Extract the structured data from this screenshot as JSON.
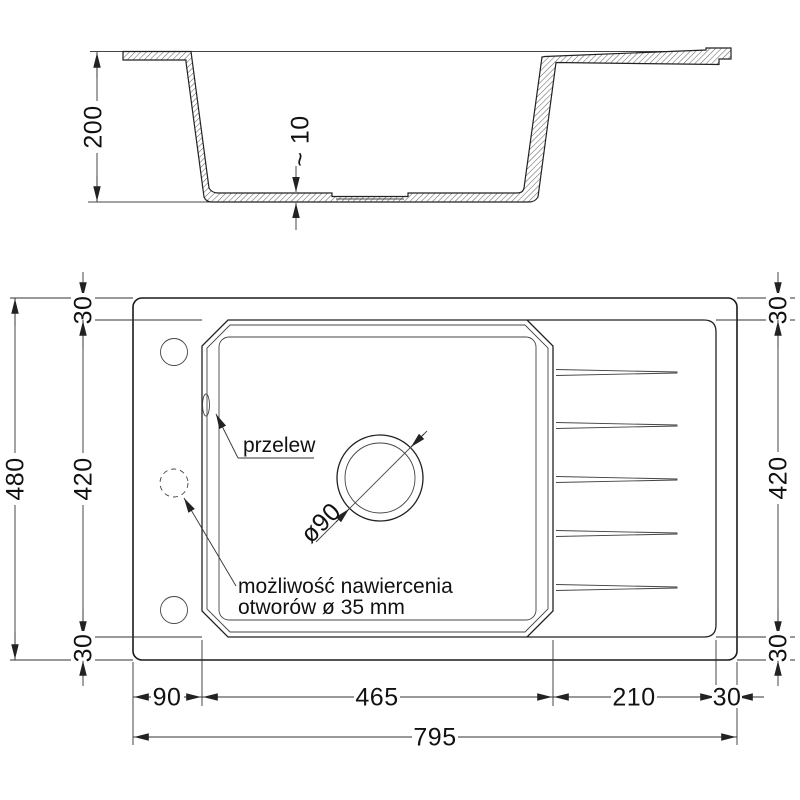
{
  "section_view": {
    "dim_height": "200",
    "dim_floor_thickness": "~ 10"
  },
  "plan_view": {
    "dim_total_height": "480",
    "dim_rim_top_left": "30",
    "dim_inner_height_left": "420",
    "dim_rim_bottom_left": "30",
    "dim_rim_top_right": "30",
    "dim_inner_height_right": "420",
    "dim_rim_bottom_right": "30",
    "dim_left_rim_width": "90",
    "dim_bowl_width": "465",
    "dim_drainboard_width": "210",
    "dim_right_rim_width": "30",
    "dim_total_width": "795",
    "label_overflow": "przelew",
    "label_drain_diameter": "ø90",
    "label_drill_line1": "możliwość nawiercenia",
    "label_drill_line2": "otworów ø 35 mm"
  },
  "colors": {
    "line": "#1a1a1a",
    "dim_line": "#333333",
    "background": "#ffffff"
  }
}
